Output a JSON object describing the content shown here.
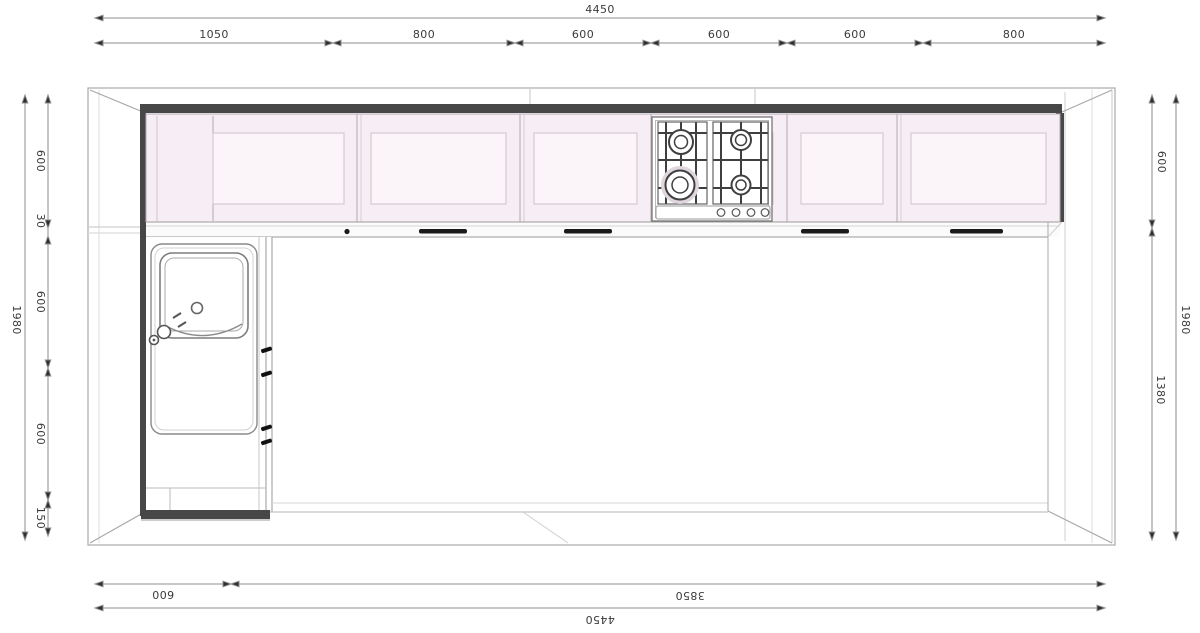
{
  "drawing": {
    "type": "kitchen-floor-plan-top-view",
    "fixtures": [
      "upper-cabinet-run",
      "gas-hob-4-burner",
      "hob-control-knobs",
      "worktop-with-door-handles",
      "base-counter-left",
      "sink-with-drainer",
      "sink-drain",
      "faucet"
    ],
    "colors": {
      "cabinet_fill": "#f6edf5",
      "cabinet_inner_fill": "#fbf5fa",
      "wall_dark": "#474747",
      "line_gray": "#a9a9a9",
      "dim_line": "#8c8c8c",
      "handle_dark": "#1b1b1b",
      "dim_text": "#3b3b3b"
    }
  },
  "dimensions": {
    "top": {
      "overall": "4450",
      "segments": [
        "1050",
        "800",
        "600",
        "600",
        "600",
        "800"
      ]
    },
    "bottom": {
      "overall": "4450",
      "segments": [
        "600",
        "3850"
      ]
    },
    "left": {
      "overall": "1980",
      "segments": [
        "600",
        "30",
        "600",
        "600",
        "150"
      ]
    },
    "right": {
      "overall": "1980",
      "segments": [
        "600",
        "1380"
      ]
    }
  }
}
